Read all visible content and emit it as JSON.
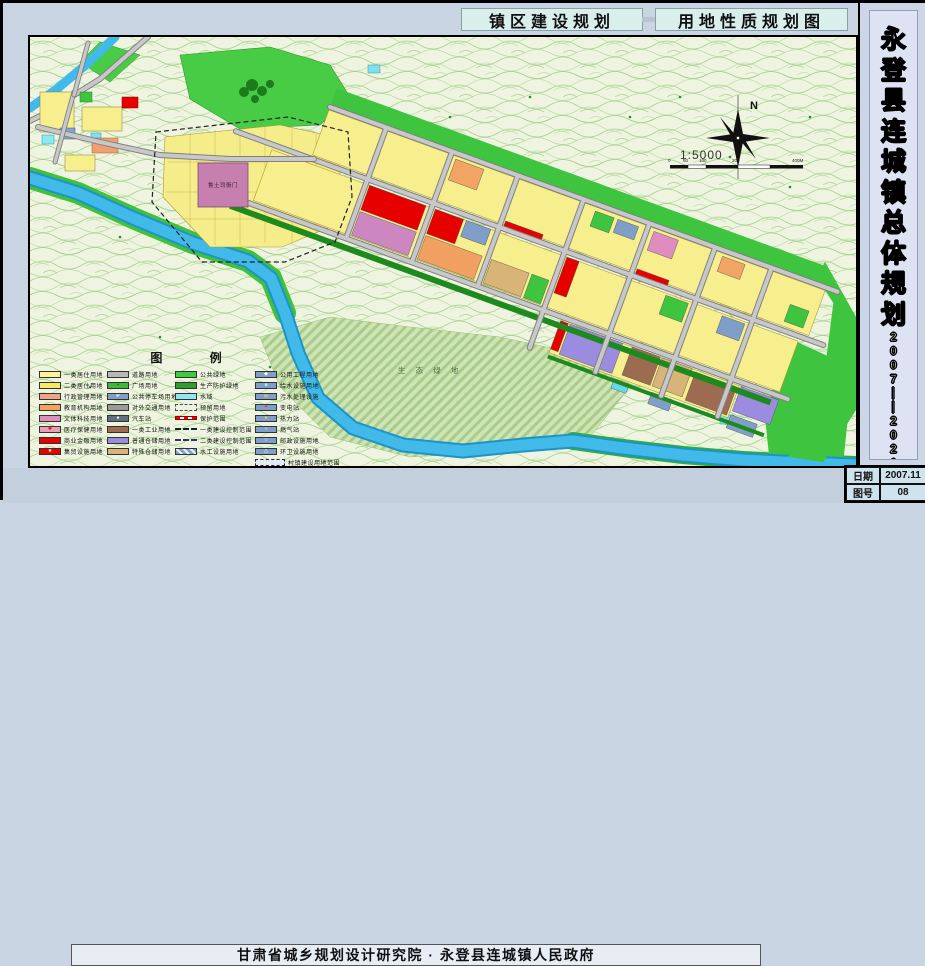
{
  "header": {
    "title_left": "镇区建设规划",
    "title_right": "用地性质规划图"
  },
  "sidebar": {
    "title": "永登县连城镇总体规划",
    "period": "2007——2020"
  },
  "footer": {
    "credit": "甘肃省城乡规划设计研究院 · 永登县连城镇人民政府"
  },
  "titleblock": {
    "date_label": "日期",
    "date_value": "2007.11",
    "sheet_label": "图号",
    "sheet_value": "08"
  },
  "compass": {
    "north": "N",
    "scale": "1:5000",
    "scalebar_labels": [
      "0",
      "50",
      "100",
      "200",
      "400M"
    ]
  },
  "map_labels": {
    "heritage_site": "鲁土司衙门",
    "eco_green": "生 态 绿 地"
  },
  "legend": {
    "title": "图 例",
    "columns": [
      [
        {
          "label": "一类居住用地",
          "color": "#fdf49a",
          "style": "fill"
        },
        {
          "label": "二类居住用地",
          "color": "#f6e96a",
          "style": "fill"
        },
        {
          "label": "行政管理用地",
          "color": "#f2a488",
          "style": "fill"
        },
        {
          "label": "教育机构用地",
          "color": "#f2a45f",
          "style": "fill"
        },
        {
          "label": "文体科技用地",
          "color": "#e08cc0",
          "style": "fill"
        },
        {
          "label": "医疗保健用地",
          "color": "#eb9db2",
          "style": "fill",
          "icon": "✚",
          "icon_color": "#cc0000"
        },
        {
          "label": "商业金融用地",
          "color": "#e60000",
          "style": "fill"
        },
        {
          "label": "集贸设施用地",
          "color": "#e60000",
          "style": "fill",
          "icon": "★",
          "icon_color": "#ffffff"
        }
      ],
      [
        {
          "label": "道路用地",
          "color": "#b8b8b8",
          "style": "fill"
        },
        {
          "label": "广场用地",
          "color": "#3db83d",
          "style": "fill",
          "icon": "▪",
          "icon_color": "#0a4a0a"
        },
        {
          "label": "公共停车场用地",
          "color": "#7f9fc8",
          "style": "fill",
          "icon": "P",
          "icon_color": "#ffffff"
        },
        {
          "label": "对外交通用地",
          "color": "#9a9a9a",
          "style": "fill"
        },
        {
          "label": "汽车站",
          "color": "#5f6f7f",
          "style": "fill",
          "icon": "●",
          "icon_color": "#ffffff"
        },
        {
          "label": "一类工业用地",
          "color": "#9c6b50",
          "style": "fill"
        },
        {
          "label": "普通仓储用地",
          "color": "#9b8ce0",
          "style": "fill"
        },
        {
          "label": "特殊仓储用地",
          "color": "#d8b478",
          "style": "fill"
        }
      ],
      [
        {
          "label": "公共绿地",
          "color": "#3ecb3e",
          "style": "fill"
        },
        {
          "label": "生产防护绿地",
          "color": "#2e9e2e",
          "style": "fill"
        },
        {
          "label": "水域",
          "color": "#8fe7f2",
          "style": "fill"
        },
        {
          "label": "预留用地",
          "color": "#eef3dc",
          "style": "dash-box"
        },
        {
          "label": "保护范围",
          "style": "line-red-dash"
        },
        {
          "label": "一类建设控制范围",
          "style": "line-dashdot"
        },
        {
          "label": "二类建设控制范围",
          "style": "line-dash"
        },
        {
          "label": "水工设施用地",
          "style": "hatch"
        }
      ],
      [
        {
          "label": "公用工程用地",
          "color": "#7f9fc8",
          "style": "fill",
          "icon": "◆",
          "icon_color": "#ffffff"
        },
        {
          "label": "给水设施用地",
          "color": "#7f9fc8",
          "style": "fill",
          "icon": "■",
          "icon_color": "#aaf0ff"
        },
        {
          "label": "污水处理设施",
          "color": "#7f9fc8",
          "style": "fill",
          "icon": "◎",
          "icon_color": "#ffee66"
        },
        {
          "label": "变电站",
          "color": "#7f9fc8",
          "style": "fill",
          "icon": "✦",
          "icon_color": "#ff2222"
        },
        {
          "label": "热力站",
          "color": "#7f9fc8",
          "style": "fill",
          "icon": "●",
          "icon_color": "#ffcc66"
        },
        {
          "label": "燃气站",
          "color": "#7f9fc8",
          "style": "fill",
          "icon": "○",
          "icon_color": "#ffffff"
        },
        {
          "label": "邮政设施用地",
          "color": "#7f9fc8",
          "style": "fill",
          "icon": "☆",
          "icon_color": "#ffffff"
        },
        {
          "label": "环卫设施用地",
          "color": "#7f9fc8",
          "style": "fill",
          "icon": "△",
          "icon_color": "#ffffff"
        },
        {
          "label": "村镇建设用地范围",
          "color": "#e4ebf4",
          "style": "wide-dash-box"
        }
      ]
    ]
  },
  "colors": {
    "residential": "#f7ee8e",
    "commercial": "#e60000",
    "culture": "#cc86c0",
    "education": "#f0a060",
    "industry": "#9c6b50",
    "storage": "#9b8ce0",
    "public_green": "#3ec43e",
    "protective_green": "#1e8a1e",
    "water": "#41b9e9",
    "utility": "#7f9fc8",
    "road": "#c8c8c8",
    "sheet_margin": "#c9d5e3",
    "title_box": "#d9efec",
    "map_background": "#eef4df"
  }
}
